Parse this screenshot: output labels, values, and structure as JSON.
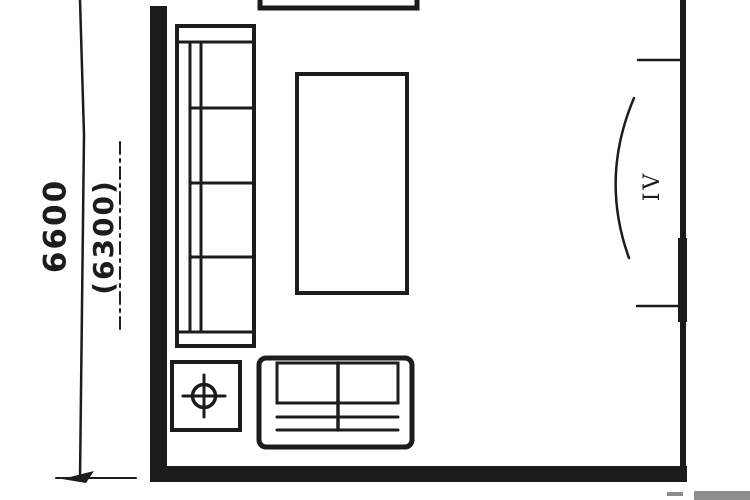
{
  "colors": {
    "ink": "#1c1c1c",
    "paper": "#ffffff",
    "strip": "#8d8d8d"
  },
  "dimensions": {
    "overall": "6600",
    "interior": "(6300)"
  },
  "door": {
    "label": "IV"
  }
}
